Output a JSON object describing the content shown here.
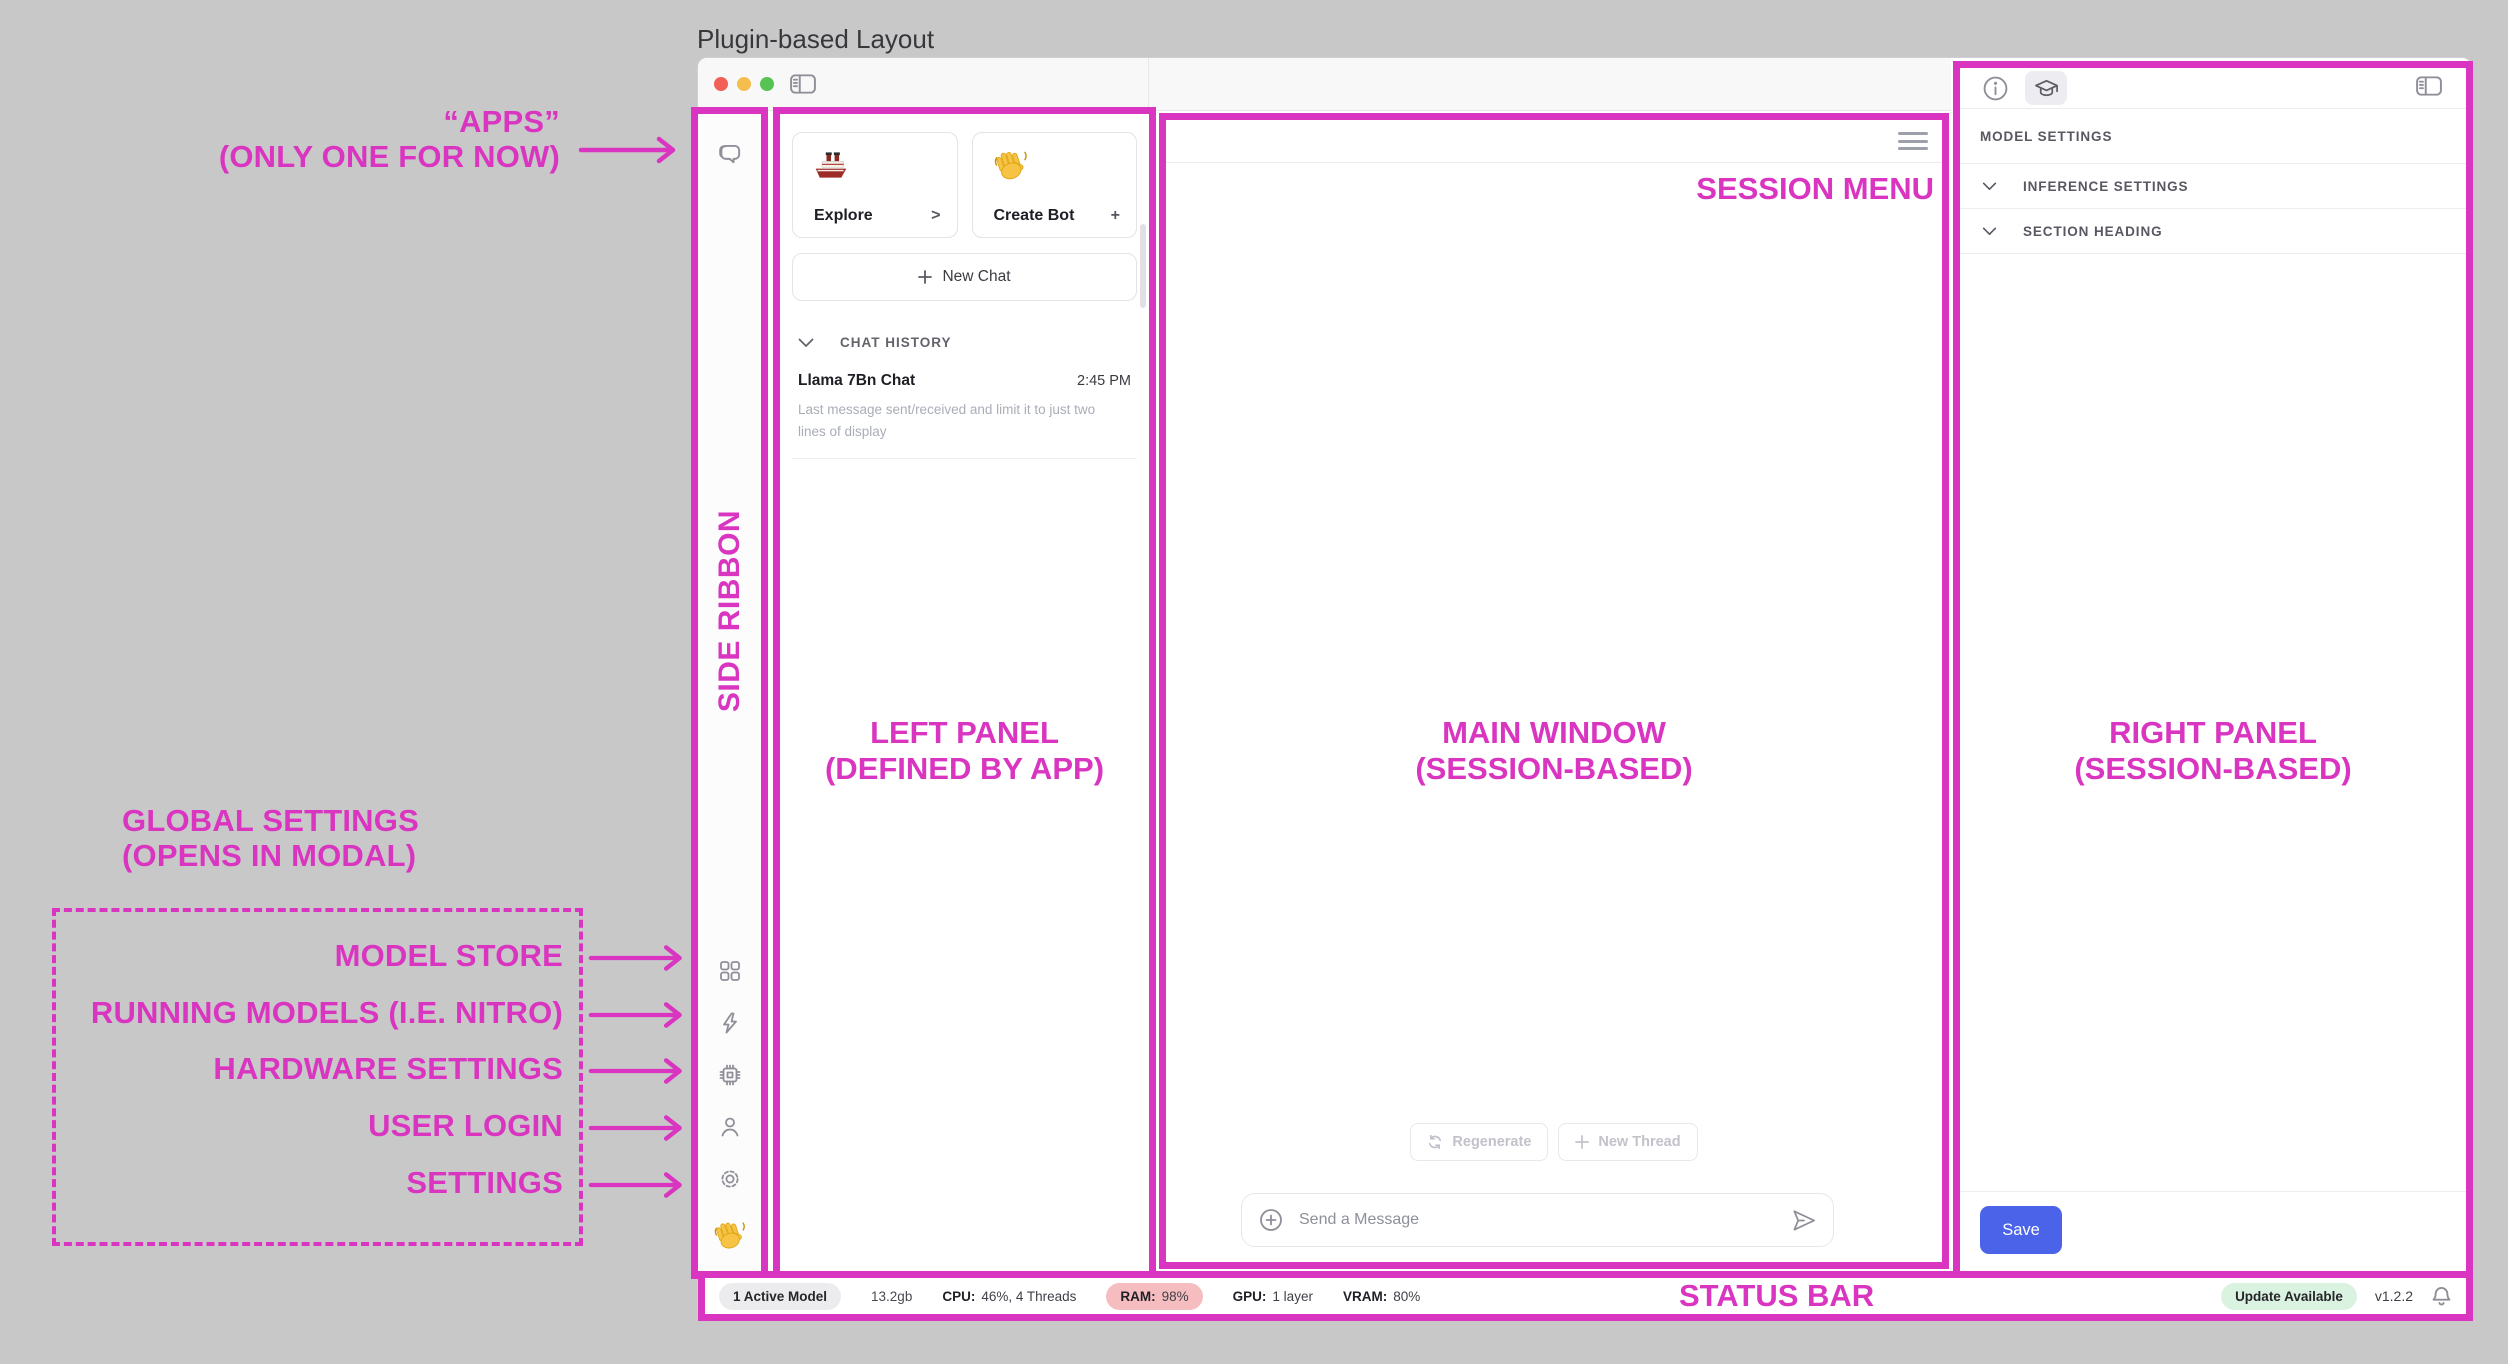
{
  "canvas": {
    "title": "Plugin-based Layout"
  },
  "colors": {
    "annotation_magenta": "#D935C0",
    "canvas_gray": "#C8C8C9",
    "save_blue": "#4A63E8",
    "ram_pill_red": "#F5BDBF",
    "update_pill_green": "#DAF3E1",
    "active_model_pill_gray": "#ECECEE"
  },
  "annotations": {
    "apps_line1": "“APPS”",
    "apps_line2": "(ONLY ONE FOR NOW)",
    "side_ribbon": "SIDE RIBBON",
    "left_panel_line1": "LEFT PANEL",
    "left_panel_line2": "(DEFINED BY APP)",
    "main_window_line1": "MAIN WINDOW",
    "main_window_line2": "(SESSION-BASED)",
    "right_panel_line1": "RIGHT PANEL",
    "right_panel_line2": "(SESSION-BASED)",
    "session_menu": "SESSION MENU",
    "status_bar": "STATUS BAR",
    "global_line1": "GLOBAL SETTINGS",
    "global_line2": "(OPENS IN MODAL)",
    "ribbon_callouts": [
      {
        "label": "MODEL STORE"
      },
      {
        "label": "RUNNING MODELS (I.E. NITRO)"
      },
      {
        "label": "HARDWARE SETTINGS"
      },
      {
        "label": "USER LOGIN"
      },
      {
        "label": "SETTINGS"
      }
    ]
  },
  "left_panel": {
    "cards": [
      {
        "icon": "ship-emoji",
        "label": "Explore",
        "affordance": ">"
      },
      {
        "icon": "wave-emoji",
        "label": "Create Bot",
        "affordance": "+"
      }
    ],
    "new_chat_label": "New Chat",
    "history_header": "CHAT HISTORY",
    "chats": [
      {
        "title": "Llama 7Bn Chat",
        "time": "2:45 PM",
        "preview": "Last message sent/received and limit it to just two lines of display"
      }
    ]
  },
  "main": {
    "regenerate_label": "Regenerate",
    "new_thread_label": "New Thread",
    "composer_placeholder": "Send a Message"
  },
  "right_panel": {
    "model_settings_label": "MODEL SETTINGS",
    "sections": [
      {
        "label": "INFERENCE SETTINGS"
      },
      {
        "label": "SECTION HEADING"
      }
    ],
    "save_label": "Save"
  },
  "status_bar": {
    "active_model": "1 Active Model",
    "model_size": "13.2gb",
    "stats": [
      {
        "label": "CPU:",
        "value": "46%, 4 Threads"
      },
      {
        "label": "RAM:",
        "value": "98%"
      },
      {
        "label": "GPU:",
        "value": "1 layer"
      },
      {
        "label": "VRAM:",
        "value": "80%"
      }
    ],
    "update_badge": "Update Available",
    "version": "v1.2.2"
  }
}
